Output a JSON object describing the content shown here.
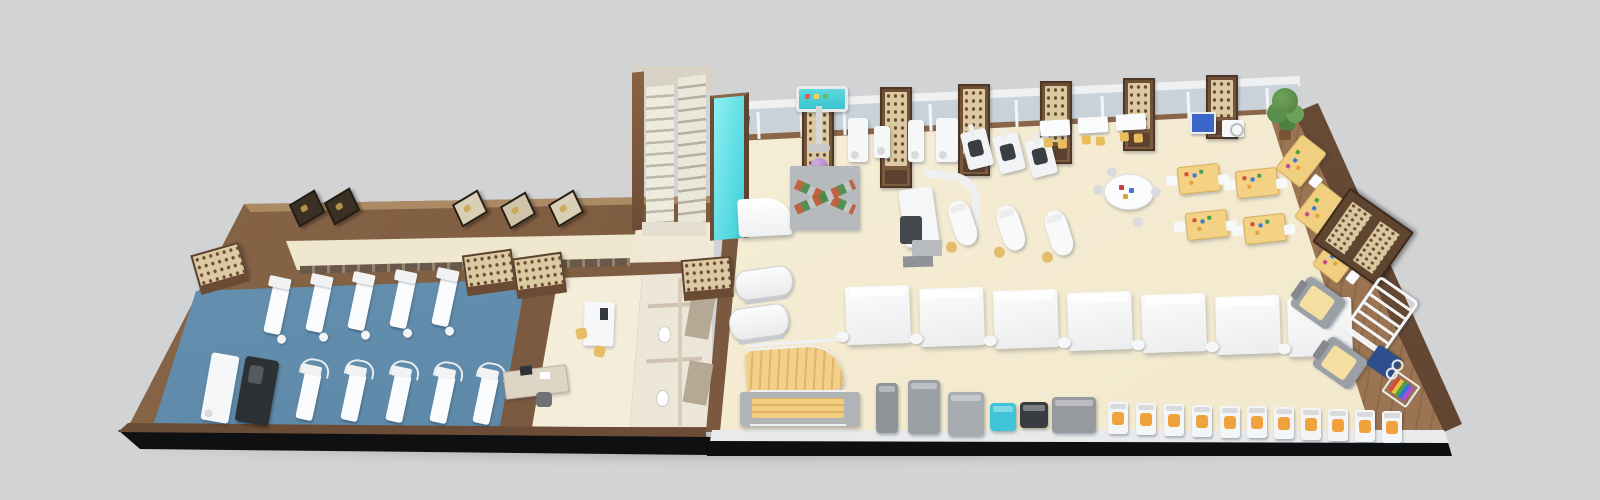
{
  "scene": {
    "title": "3D isometric floor plan of a rehabilitation training facility",
    "background": "#d2d3d5"
  },
  "palette": {
    "background": "#d2d3d5",
    "plinth_black": "#0f1012",
    "wood_dark": "#6b4b33",
    "wood_mid": "#7d5b40",
    "wood_light": "#ab8a64",
    "floor_cream": "#f4edd6",
    "floor_blue": "#6493b5",
    "window_glass": "#c9d3da",
    "teal_screen": "#4fd4dc",
    "purple_ball": "#a683cc",
    "table_yellow": "#f3d285",
    "seat_orange": "#f0a33c",
    "lattice_beige": "#dbcaa2"
  },
  "areas": {
    "pt_room": "Physical therapy room with blue carpet and treatment beds",
    "training_hall": "Main rehabilitation training hall",
    "stairs": "Staircase",
    "restrooms": "Restrooms with stalls",
    "office": "Staff desk area",
    "reception": "Reception counter",
    "parallel_bars": "Gait training area with parallel bars and steps",
    "glass_panel": "Teal glass panel",
    "top_wall": "Window wall with lattice pillars",
    "right_wall": "Wood wall with sign cabinet"
  },
  "equipment": {
    "beds_top": {
      "label": "treatment beds (upper row)",
      "items": [
        {
          "x": 268,
          "y": 286,
          "r": 12
        },
        {
          "x": 310,
          "y": 284,
          "r": 12
        },
        {
          "x": 352,
          "y": 282,
          "r": 12
        },
        {
          "x": 394,
          "y": 280,
          "r": 12
        },
        {
          "x": 436,
          "y": 278,
          "r": 12
        }
      ]
    },
    "beds_bottom": {
      "label": "treatment beds with trapeze frames (lower row)",
      "items": [
        {
          "x": 300,
          "y": 372,
          "r": 12
        },
        {
          "x": 345,
          "y": 373,
          "r": 12
        },
        {
          "x": 390,
          "y": 374,
          "r": 12
        },
        {
          "x": 434,
          "y": 375,
          "r": 12
        },
        {
          "x": 477,
          "y": 376,
          "r": 12
        }
      ]
    },
    "mats": {
      "label": "mat platform tables",
      "items": [
        {
          "x": 846,
          "y": 286
        },
        {
          "x": 920,
          "y": 288
        },
        {
          "x": 994,
          "y": 290
        },
        {
          "x": 1068,
          "y": 292
        },
        {
          "x": 1142,
          "y": 294
        },
        {
          "x": 1216,
          "y": 296
        },
        {
          "x": 1288,
          "y": 298
        }
      ]
    },
    "couches": {
      "label": "treatment couches with stools",
      "items": [
        {
          "x": 952,
          "y": 200
        },
        {
          "x": 1000,
          "y": 205
        },
        {
          "x": 1048,
          "y": 210
        }
      ]
    },
    "yellow_tables": {
      "label": "occupational therapy tables",
      "items": [
        {
          "x": 1178,
          "y": 165
        },
        {
          "x": 1236,
          "y": 169
        },
        {
          "x": 1186,
          "y": 211
        },
        {
          "x": 1244,
          "y": 215
        }
      ]
    },
    "yellow_desks": {
      "label": "work desks along right wall",
      "items": [
        {
          "x": 1279,
          "y": 145
        },
        {
          "x": 1298,
          "y": 193
        },
        {
          "x": 1316,
          "y": 241
        }
      ]
    },
    "orange_machines": {
      "label": "strength machines with orange seats",
      "items": [
        {
          "x": 1108,
          "y": 402
        },
        {
          "x": 1136,
          "y": 403
        },
        {
          "x": 1164,
          "y": 404
        },
        {
          "x": 1192,
          "y": 405
        },
        {
          "x": 1220,
          "y": 406
        },
        {
          "x": 1247,
          "y": 406
        },
        {
          "x": 1274,
          "y": 407
        },
        {
          "x": 1301,
          "y": 408
        },
        {
          "x": 1328,
          "y": 409
        },
        {
          "x": 1355,
          "y": 410
        },
        {
          "x": 1382,
          "y": 411
        }
      ]
    },
    "gym_machines": {
      "label": "cardio machines row",
      "items": [
        {
          "x": 876,
          "y": 383,
          "w": 22,
          "h": 50,
          "bg": "#8f9498"
        },
        {
          "x": 908,
          "y": 380,
          "w": 32,
          "h": 54,
          "bg": "#9aa0a4"
        },
        {
          "x": 948,
          "y": 392,
          "w": 36,
          "h": 44,
          "bg": "#a7acb0"
        },
        {
          "x": 990,
          "y": 403,
          "w": 26,
          "h": 28,
          "bg": "#3ec6d8"
        },
        {
          "x": 1020,
          "y": 402,
          "w": 28,
          "h": 26,
          "bg": "#3a3d40"
        },
        {
          "x": 1052,
          "y": 397,
          "w": 44,
          "h": 36,
          "bg": "#96999d"
        }
      ]
    },
    "white_units": {
      "label": "white rehab devices",
      "items": [
        {
          "x": 848,
          "y": 118,
          "w": 20,
          "h": 44
        },
        {
          "x": 874,
          "y": 126,
          "w": 16,
          "h": 32
        },
        {
          "x": 908,
          "y": 120,
          "w": 16,
          "h": 42
        },
        {
          "x": 936,
          "y": 118,
          "w": 22,
          "h": 44
        },
        {
          "x": 206,
          "y": 354,
          "w": 28,
          "h": 68,
          "r": 10
        }
      ]
    },
    "black_seat_units": {
      "label": "exercise devices with dark seats",
      "items": [
        {
          "x": 964,
          "y": 130
        },
        {
          "x": 996,
          "y": 134
        },
        {
          "x": 1028,
          "y": 138
        }
      ]
    },
    "white_tables": {
      "label": "therapy tables with yellow chairs",
      "items": [
        {
          "x": 1040,
          "y": 120
        },
        {
          "x": 1078,
          "y": 117
        },
        {
          "x": 1116,
          "y": 114
        }
      ]
    },
    "pillars": {
      "label": "lattice wall pillars",
      "items": [
        {
          "x": 802,
          "y": 90,
          "h": 106
        },
        {
          "x": 880,
          "y": 87,
          "h": 97
        },
        {
          "x": 958,
          "y": 84,
          "h": 88
        },
        {
          "x": 1040,
          "y": 81,
          "h": 79
        },
        {
          "x": 1123,
          "y": 78,
          "h": 69
        },
        {
          "x": 1206,
          "y": 75,
          "h": 60
        }
      ]
    },
    "mullions": {
      "label": "window mullions",
      "items": [
        {
          "x": 757,
          "y": 112
        },
        {
          "x": 800,
          "y": 110
        },
        {
          "x": 843,
          "y": 108
        },
        {
          "x": 886,
          "y": 106
        },
        {
          "x": 929,
          "y": 104
        },
        {
          "x": 972,
          "y": 102
        },
        {
          "x": 1015,
          "y": 100
        },
        {
          "x": 1058,
          "y": 98
        },
        {
          "x": 1101,
          "y": 96
        },
        {
          "x": 1144,
          "y": 94
        },
        {
          "x": 1187,
          "y": 92
        },
        {
          "x": 1230,
          "y": 90
        },
        {
          "x": 1266,
          "y": 88
        }
      ]
    },
    "pictures": {
      "label": "framed pictures leaning on outer wall",
      "items": [
        {
          "x": 292,
          "y": 196,
          "bg": "#3a3023"
        },
        {
          "x": 327,
          "y": 194,
          "bg": "#3a3023"
        },
        {
          "x": 455,
          "y": 196,
          "bg": "#d9cfb4"
        },
        {
          "x": 503,
          "y": 198,
          "bg": "#cfc4a8"
        },
        {
          "x": 551,
          "y": 196,
          "bg": "#d9cfb4"
        }
      ]
    },
    "cabinets": {
      "label": "lattice-top wall cabinets",
      "items": [
        {
          "x": 194,
          "y": 248,
          "r": -16
        },
        {
          "x": 464,
          "y": 252,
          "r": -8
        },
        {
          "x": 514,
          "y": 255,
          "r": -8
        },
        {
          "x": 682,
          "y": 258,
          "r": -5
        }
      ]
    },
    "recliners": {
      "label": "recliner chairs with yellow blankets",
      "items": [
        {
          "x": 1300,
          "y": 280
        },
        {
          "x": 1322,
          "y": 340
        }
      ]
    },
    "tilt_beds": {
      "label": "tilting treatment beds",
      "items": [
        {
          "x": 735,
          "y": 268,
          "w": 56,
          "h": 28
        },
        {
          "x": 729,
          "y": 306,
          "w": 58,
          "h": 30
        }
      ]
    }
  }
}
